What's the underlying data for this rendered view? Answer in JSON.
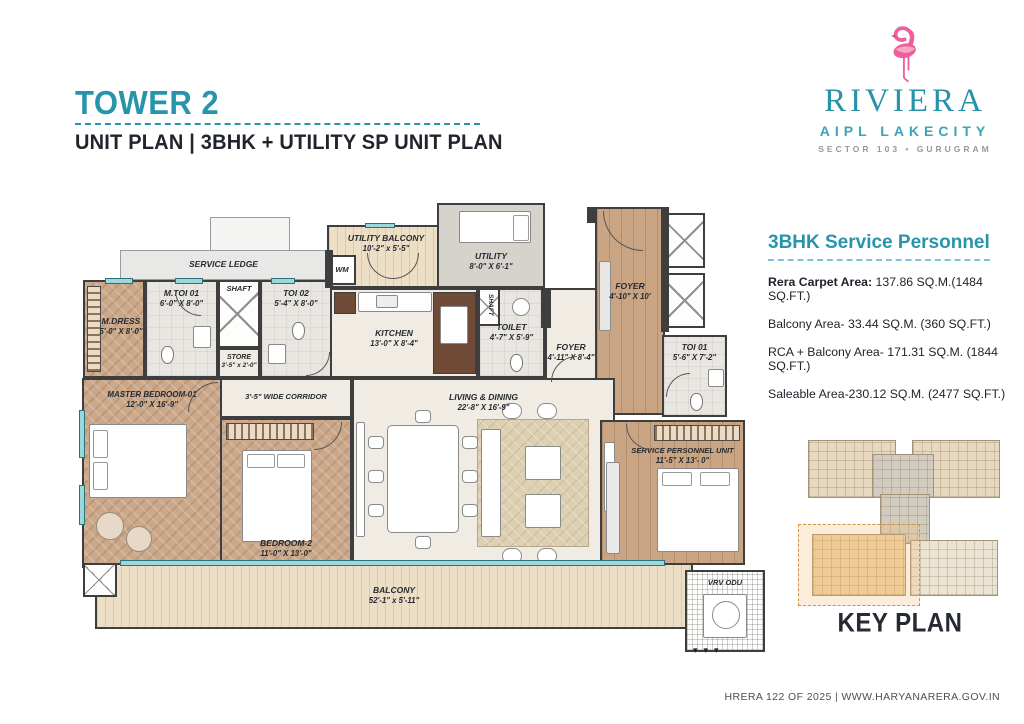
{
  "header": {
    "tower": "TOWER 2",
    "subtitle": "UNIT PLAN   |   3BHK + UTILITY SP UNIT PLAN"
  },
  "logo": {
    "brand": "RIVIERA",
    "sub_brand": "AIPL LAKECITY",
    "location": "SECTOR 103 • GURUGRAM",
    "flamingo_icon": "flamingo"
  },
  "unit_info": {
    "title": "3BHK  Service Personnel",
    "lines": [
      {
        "label": "Rera Carpet Area:",
        "value": " 137.86 SQ.M.(1484 SQ.FT.)"
      },
      {
        "label": "Balcony Area-",
        "value": " 33.44  SQ.M. (360 SQ.FT.)"
      },
      {
        "label": "RCA + Balcony Area-",
        "value": " 171.31 SQ.M. (1844 SQ.FT.)"
      },
      {
        "label": "Saleable Area-",
        "value": "230.12 SQ.M. (2477 SQ.FT.)"
      }
    ]
  },
  "rooms": {
    "service_ledge": {
      "name": "SERVICE LEDGE",
      "dims": ""
    },
    "m_dress": {
      "name": "M.DRESS",
      "dims": "5'-0\" X 8'-0\""
    },
    "m_toi_01": {
      "name": "M.TOI 01",
      "dims": "6'-0\" X 8'-0\""
    },
    "shaft_top": {
      "name": "SHAFT",
      "dims": ""
    },
    "toi_02": {
      "name": "TOI 02",
      "dims": "5'-4\" X 8'-0\""
    },
    "store": {
      "name": "STORE",
      "dims": "3'-5\" x 2'-0\""
    },
    "wm": {
      "name": "WM",
      "dims": ""
    },
    "utility_balcony": {
      "name": "UTILITY BALCONY",
      "dims": "10'-2\" x 5'-5\""
    },
    "utility": {
      "name": "UTILITY",
      "dims": "8'-0\" X 6'-1\""
    },
    "kitchen": {
      "name": "KITCHEN",
      "dims": "13'-0\" X 8'-4\""
    },
    "shaft_small": {
      "name": "SHAFT",
      "dims": ""
    },
    "toilet": {
      "name": "TOILET",
      "dims": "4'-7\" X 5'-9\""
    },
    "foyer_inner": {
      "name": "FOYER",
      "dims": "4'-11\" X 8'-4\""
    },
    "foyer_entry": {
      "name": "FOYER",
      "dims": "4'-10\" X 10'"
    },
    "toi_01": {
      "name": "TOI 01",
      "dims": "5'-6\" X 7'-2\""
    },
    "master_bedroom": {
      "name": "MASTER BEDROOM-01",
      "dims": "12'-0\" X 16'-9\""
    },
    "corridor": {
      "name": "3'-5\" WIDE CORRIDOR",
      "dims": ""
    },
    "living_dining": {
      "name": "LIVING & DINING",
      "dims": "22'-8\" X 16'-9\""
    },
    "bedroom_2": {
      "name": "BEDROOM-2",
      "dims": "11'-0\" X 13'-0\""
    },
    "service_personnel_unit": {
      "name": "SERVICE PERSONNEL UNIT",
      "dims": "11'-5\" X 13'- 0\""
    },
    "balcony": {
      "name": "BALCONY",
      "dims": "52'-1\" x 5'-11\""
    },
    "vrv_odu": {
      "name": "VRV ODU",
      "dims": ""
    }
  },
  "key_plan": {
    "title": "KEY PLAN"
  },
  "footer": {
    "text": "HRERA 122 OF 2025 | WWW.HARYANARERA.GOV.IN"
  },
  "colors": {
    "accent_teal": "#2794ac",
    "dark_text": "#20242c",
    "flamingo_pink": "#ef5f9a",
    "wall": "#3e3e3e",
    "wood_floor": "#cba88a",
    "highlight_orange": "#d1933f",
    "window_teal": "#9ad8db"
  }
}
